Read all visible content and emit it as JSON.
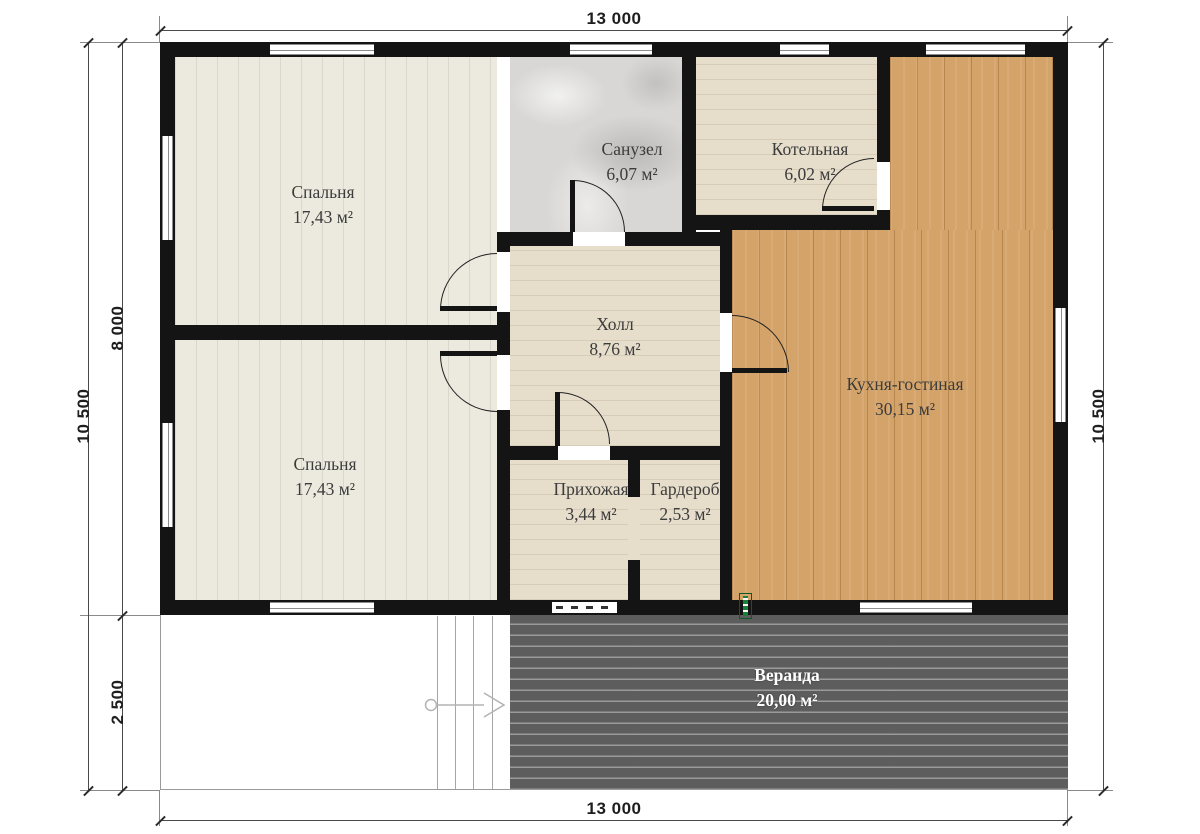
{
  "plan_title": "floor-plan",
  "rooms": {
    "bedroom1": {
      "name": "Спальня",
      "area": "17,43 м²"
    },
    "bedroom2": {
      "name": "Спальня",
      "area": "17,43 м²"
    },
    "bathroom": {
      "name": "Санузел",
      "area": "6,07 м²"
    },
    "boiler": {
      "name": "Котельная",
      "area": "6,02 м²"
    },
    "hall": {
      "name": "Холл",
      "area": "8,76 м²"
    },
    "kitchen": {
      "name": "Кухня-гостиная",
      "area": "30,15 м²"
    },
    "entry": {
      "name": "Прихожая",
      "area": "3,44 м²"
    },
    "wardrobe": {
      "name": "Гардероб",
      "area": "2,53 м²"
    },
    "veranda": {
      "name": "Веранда",
      "area": "20,00 м²"
    }
  },
  "dimensions": {
    "width_top": "13 000",
    "width_bottom": "13 000",
    "height_left_total": "10 500",
    "height_right_total": "10 500",
    "house_depth": "8 000",
    "veranda_depth": "2 500"
  },
  "colors": {
    "wall": "#141414",
    "bedroom": "#ece9df",
    "bath": "#d8d7d5",
    "utility": "#e6ddcb",
    "kitchen": "#d4a369",
    "veranda": "#5d5d5d",
    "marker": "#1c7f3a"
  }
}
